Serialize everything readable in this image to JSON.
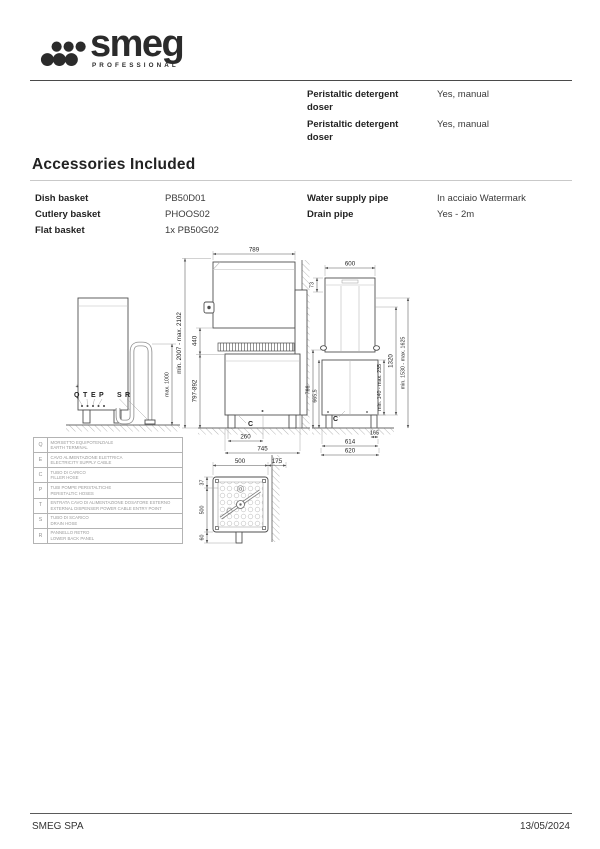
{
  "logo": {
    "word": "smeg",
    "subtitle": "PROFESSIONAL",
    "dots_icon": "smeg-dot-cluster",
    "color": "#2b2b2b"
  },
  "specs": {
    "rows": [
      {
        "label": "Peristaltic detergent doser",
        "value": "Yes, manual"
      },
      {
        "label": "Peristaltic detergent doser",
        "value": "Yes, manual"
      }
    ]
  },
  "accessories": {
    "heading": "Accessories Included",
    "left_rows": [
      {
        "label": "Dish basket",
        "value": "PB50D01"
      },
      {
        "label": "Cutlery basket",
        "value": "PHOOS02"
      },
      {
        "label": "Flat basket",
        "value": "1x PB50G02"
      }
    ],
    "right_rows": [
      {
        "label": "Water supply pipe",
        "value": "In acciaio Watermark"
      },
      {
        "label": "Drain pipe",
        "value": "Yes - 2m"
      }
    ]
  },
  "diagram": {
    "back_view": {
      "earth_symbol": "+",
      "letters": [
        "Q",
        "T",
        "E",
        "P",
        "S",
        "R"
      ],
      "drain_height": "max. 1000"
    },
    "front_view": {
      "width": "789",
      "overall_height": "min. 2007 - max. 2102",
      "hood_stroke": "440",
      "work_height": "797-892",
      "drain_offset": "260",
      "base_width": "745",
      "section": "C"
    },
    "side_view": {
      "width": "600",
      "top_offset": "73",
      "h_766": "766",
      "h_665": "665,5",
      "clearance": "min. 140 - max. 235",
      "h_1320": "1320",
      "overall_height": "min. 1530 - max. 1625",
      "leg_offset": "165",
      "d_614": "614",
      "d_620": "620",
      "section": "C"
    },
    "top_view": {
      "width": "500",
      "wall_gap": "175",
      "d_37": "37",
      "depth": "500",
      "d_60": "60"
    },
    "legend": [
      {
        "key": "Q",
        "it": "MORSETTO EQUIPOTENZIALE",
        "en": "EARTH TERMINAL"
      },
      {
        "key": "E",
        "it": "CAVO ALIMENTAZIONE ELETTRICA",
        "en": "ELECTRICITY SUPPLY CABLE"
      },
      {
        "key": "C",
        "it": "TUBO DI CARICO",
        "en": "FILLER HOSE"
      },
      {
        "key": "P",
        "it": "TUBI POMPE PERISTALTICHE",
        "en": "PERISTALTIC HOSES"
      },
      {
        "key": "T",
        "it": "ENTRATA CAVO DI ALIMENTAZIONE DOSATORE ESTERNO",
        "en": "EXTERNAL DISPENSER POWER CABLE ENTRY POINT"
      },
      {
        "key": "S",
        "it": "TUBO DI SCARICO",
        "en": "DRAIN HOSE"
      },
      {
        "key": "R",
        "it": "PANNELLO RETRO",
        "en": "LOWER BACK PANEL"
      }
    ]
  },
  "footer": {
    "company": "SMEG SPA",
    "date": "13/05/2024"
  },
  "colors": {
    "rule_dark": "#4a4a4a",
    "rule_light": "#c9c9c9",
    "drawing_line": "#555555",
    "legend_text": "#999999"
  }
}
